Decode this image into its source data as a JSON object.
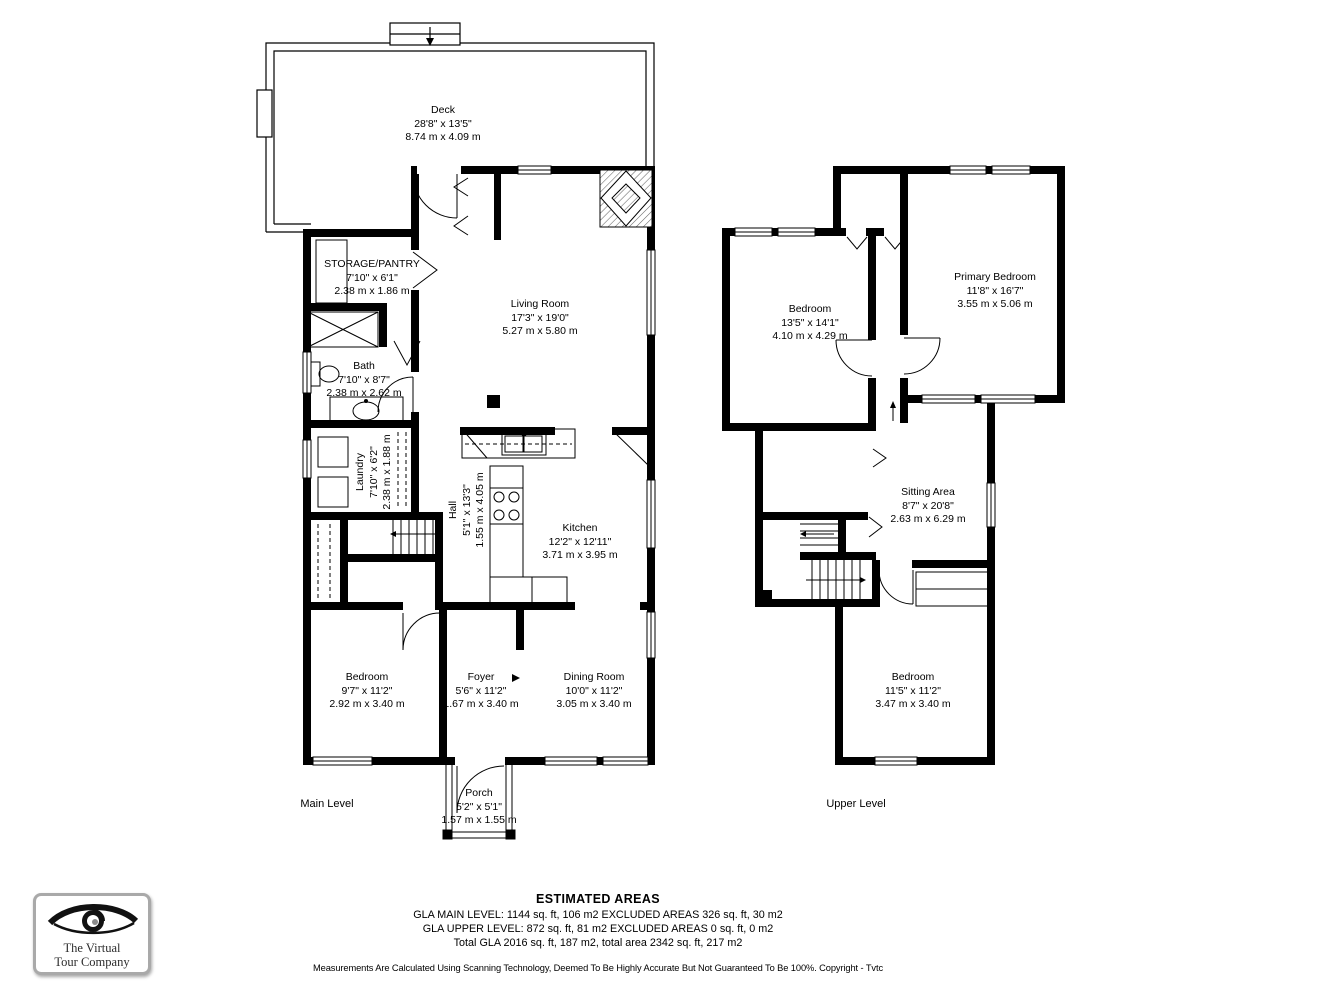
{
  "main_level": {
    "level_label": "Main Level",
    "rooms": [
      {
        "name": "Deck",
        "imperial": "28'8\" x 13'5\"",
        "metric": "8.74 m x 4.09 m"
      },
      {
        "name": "STORAGE/PANTRY",
        "imperial": "7'10\" x 6'1\"",
        "metric": "2.38 m x 1.86 m"
      },
      {
        "name": "Living Room",
        "imperial": "17'3\" x 19'0\"",
        "metric": "5.27 m x 5.80 m"
      },
      {
        "name": "Bath",
        "imperial": "7'10\" x 8'7\"",
        "metric": "2.38 m x 2.62 m"
      },
      {
        "name": "Laundry",
        "imperial": "7'10\" x 6'2\"",
        "metric": "2.38 m x 1.88 m"
      },
      {
        "name": "Hall",
        "imperial": "5'1\" x 13'3\"",
        "metric": "1.55 m x 4.05 m"
      },
      {
        "name": "Kitchen",
        "imperial": "12'2\" x 12'11\"",
        "metric": "3.71 m x 3.95 m"
      },
      {
        "name": "Bedroom",
        "imperial": "9'7\" x 11'2\"",
        "metric": "2.92 m x 3.40 m"
      },
      {
        "name": "Foyer",
        "imperial": "5'6\" x 11'2\"",
        "metric": "1.67 m x 3.40 m"
      },
      {
        "name": "Dining Room",
        "imperial": "10'0\" x 11'2\"",
        "metric": "3.05 m x 3.40 m"
      },
      {
        "name": "Porch",
        "imperial": "5'2\" x 5'1\"",
        "metric": "1.57 m x 1.55 m"
      }
    ]
  },
  "upper_level": {
    "level_label": "Upper Level",
    "rooms": [
      {
        "name": "Bedroom",
        "imperial": "13'5\" x 14'1\"",
        "metric": "4.10 m x 4.29 m"
      },
      {
        "name": "Primary Bedroom",
        "imperial": "11'8\" x 16'7\"",
        "metric": "3.55 m x 5.06 m"
      },
      {
        "name": "Sitting Area",
        "imperial": "8'7\" x 20'8\"",
        "metric": "2.63 m x 6.29 m"
      },
      {
        "name": "Bedroom",
        "imperial": "11'5\" x 11'2\"",
        "metric": "3.47 m x 3.40 m"
      }
    ]
  },
  "areas": {
    "title": "ESTIMATED AREAS",
    "line1": "GLA MAIN LEVEL: 1144 sq. ft, 106 m2 EXCLUDED AREAS 326 sq. ft, 30 m2",
    "line2": "GLA UPPER LEVEL: 872 sq. ft, 81 m2 EXCLUDED AREAS 0 sq. ft, 0 m2",
    "line3": "Total GLA 2016 sq. ft, 187 m2, total area 2342 sq. ft, 217 m2",
    "disclaimer": "Measurements Are Calculated Using Scanning Technology, Deemed To Be Highly Accurate But Not Guaranteed To Be 100%. Copyright - Tvtc"
  },
  "logo": {
    "line1": "The Virtual",
    "line2": "Tour Company",
    "icon": "eye-icon"
  },
  "colors": {
    "wall": "#000000",
    "background": "#ffffff",
    "logo_border": "#a9a9a9"
  }
}
